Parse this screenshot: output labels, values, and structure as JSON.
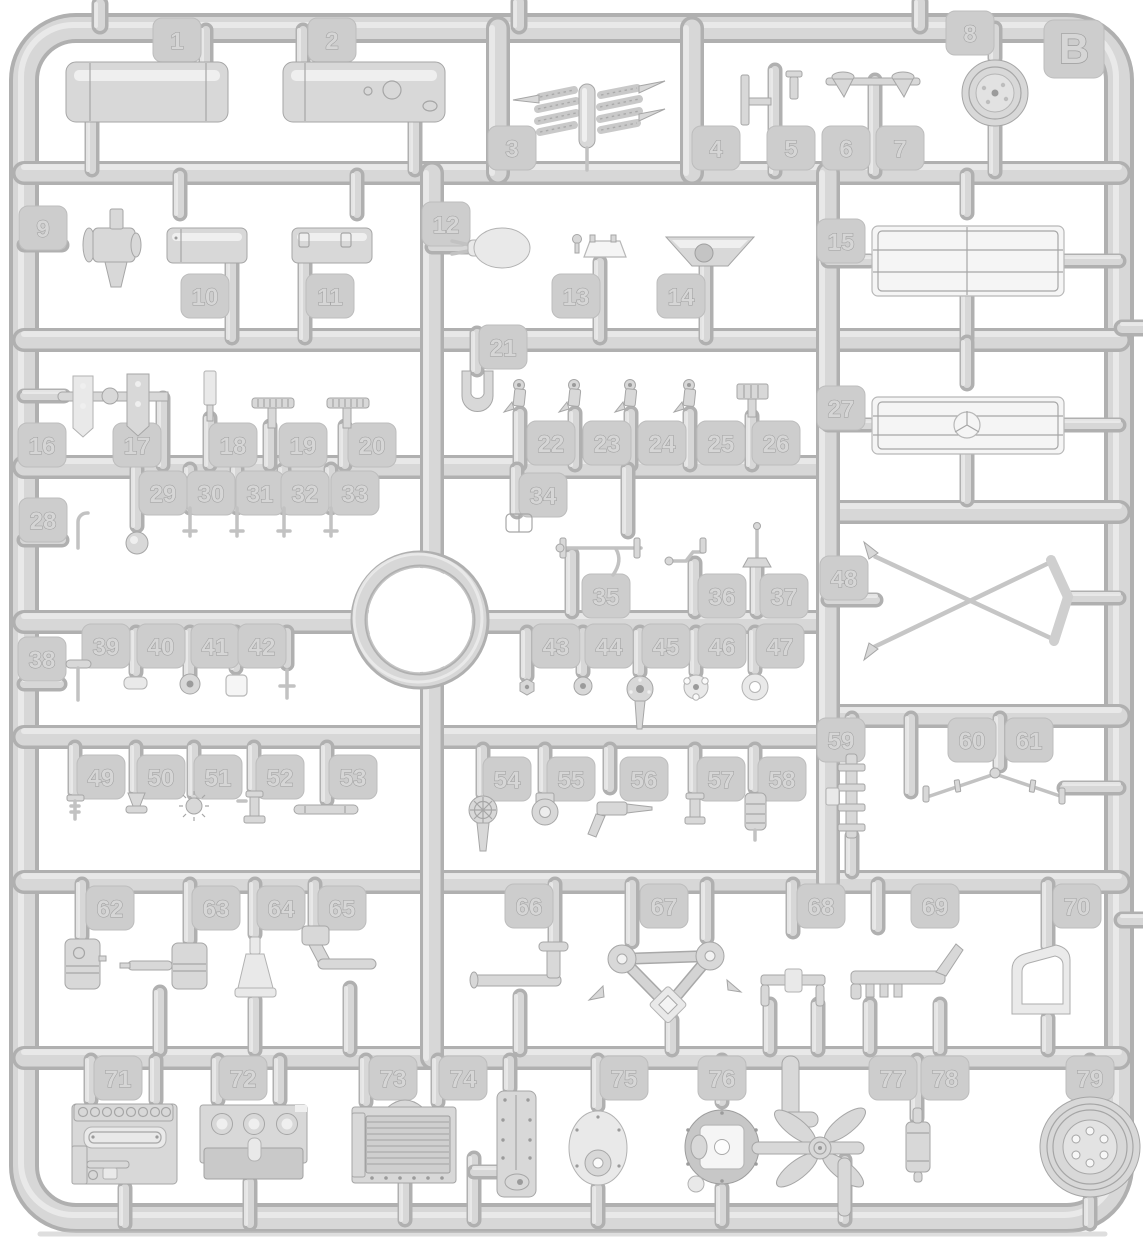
{
  "image": {
    "type": "model-kit-sprue-photo",
    "description": "Light gray injection-molded plastic sprue (parts tree) with numbered part tabs"
  },
  "sprue": {
    "letter": "B",
    "part_count": 79
  },
  "colors": {
    "background": "#ffffff",
    "plastic": "#d6d6d6",
    "plastic_shadow": "#b0b0b0",
    "plastic_highlight": "#eaeaea",
    "tab": "#cdcdcd",
    "emboss_outline": "#9d9d9d"
  },
  "parts": [
    {
      "number": 1,
      "name": "fuel-tank-cylinder"
    },
    {
      "number": 2,
      "name": "fuel-tank-cylinder-with-filler"
    },
    {
      "number": 3,
      "name": "leaf-spring-cluster"
    },
    {
      "number": 4,
      "name": "flat-mounting-plate"
    },
    {
      "number": 5,
      "name": "valve-bracket"
    },
    {
      "number": 6,
      "name": "air-horn-funnel"
    },
    {
      "number": 7,
      "name": "air-horn-funnel"
    },
    {
      "number": 8,
      "name": "pulley-wheel"
    },
    {
      "number": 9,
      "name": "water-pump"
    },
    {
      "number": 10,
      "name": "air-reservoir-tank"
    },
    {
      "number": 11,
      "name": "air-reservoir-tank"
    },
    {
      "number": 12,
      "name": "rounded-housing"
    },
    {
      "number": 13,
      "name": "seat-bracket"
    },
    {
      "number": 14,
      "name": "funnel-bowl"
    },
    {
      "number": 15,
      "name": "radiator-grille"
    },
    {
      "number": 16,
      "name": "mounting-plate"
    },
    {
      "number": 17,
      "name": "mounting-plate-with-ball"
    },
    {
      "number": 18,
      "name": "flat-strip"
    },
    {
      "number": 19,
      "name": "t-handle-ribbed"
    },
    {
      "number": 20,
      "name": "t-handle-ribbed"
    },
    {
      "number": 21,
      "name": "clevis-fork"
    },
    {
      "number": 22,
      "name": "shock-mount-bracket"
    },
    {
      "number": 23,
      "name": "shock-mount-bracket"
    },
    {
      "number": 24,
      "name": "shock-mount-bracket"
    },
    {
      "number": 25,
      "name": "shock-mount-bracket"
    },
    {
      "number": 26,
      "name": "ribbed-clamp-block"
    },
    {
      "number": 27,
      "name": "radiator-grille-with-emblem"
    },
    {
      "number": 28,
      "name": "hook-pin"
    },
    {
      "number": 29,
      "name": "cap-disc"
    },
    {
      "number": 30,
      "name": "small-pin"
    },
    {
      "number": 31,
      "name": "small-pin"
    },
    {
      "number": 32,
      "name": "small-pin"
    },
    {
      "number": 33,
      "name": "small-pin"
    },
    {
      "number": 34,
      "name": "buckle-frame"
    },
    {
      "number": 35,
      "name": "tie-rod-with-hook"
    },
    {
      "number": 36,
      "name": "lever-rod"
    },
    {
      "number": 37,
      "name": "gear-lever"
    },
    {
      "number": 38,
      "name": "flat-head-pin"
    },
    {
      "number": 39,
      "name": "rounded-pad"
    },
    {
      "number": 40,
      "name": "washer"
    },
    {
      "number": 41,
      "name": "square-pad"
    },
    {
      "number": 42,
      "name": "cross-pin"
    },
    {
      "number": 43,
      "name": "hex-nut"
    },
    {
      "number": 44,
      "name": "washer-disc"
    },
    {
      "number": 45,
      "name": "flanged-hub-with-blade"
    },
    {
      "number": 46,
      "name": "notched-disc"
    },
    {
      "number": 47,
      "name": "ring-grommet"
    },
    {
      "number": 48,
      "name": "scissor-cross-linkage"
    },
    {
      "number": 49,
      "name": "threaded-bolt"
    },
    {
      "number": 50,
      "name": "valve-cone"
    },
    {
      "number": 51,
      "name": "star-knob"
    },
    {
      "number": 52,
      "name": "spool-fitting"
    },
    {
      "number": 53,
      "name": "rod-with-handle"
    },
    {
      "number": 54,
      "name": "handwheel-with-stem"
    },
    {
      "number": 55,
      "name": "eyelet-ring"
    },
    {
      "number": 56,
      "name": "nozzle-fitting"
    },
    {
      "number": 57,
      "name": "capped-bushing"
    },
    {
      "number": 58,
      "name": "ribbed-canister"
    },
    {
      "number": 59,
      "name": "ladder-bracket"
    },
    {
      "number": 60,
      "name": "linkage-rod"
    },
    {
      "number": 61,
      "name": "linkage-rod"
    },
    {
      "number": 62,
      "name": "piston-cylinder"
    },
    {
      "number": 63,
      "name": "cylinder-with-side-rod"
    },
    {
      "number": 64,
      "name": "funnel-stand"
    },
    {
      "number": 65,
      "name": "crank-arm"
    },
    {
      "number": 66,
      "name": "exhaust-pipe-elbow"
    },
    {
      "number": 67,
      "name": "triangular-linkage-plate"
    },
    {
      "number": 68,
      "name": "t-bracket"
    },
    {
      "number": 69,
      "name": "manifold-bracket"
    },
    {
      "number": 70,
      "name": "d-shaped-cover-plate"
    },
    {
      "number": 71,
      "name": "engine-block"
    },
    {
      "number": 72,
      "name": "gearbox-mounting-plate"
    },
    {
      "number": 73,
      "name": "ribbed-oil-pan"
    },
    {
      "number": 74,
      "name": "side-cover-plate"
    },
    {
      "number": 75,
      "name": "oval-access-cover"
    },
    {
      "number": 76,
      "name": "round-hub-cover"
    },
    {
      "number": 77,
      "name": "cooling-fan-assembly"
    },
    {
      "number": 78,
      "name": "small-canister"
    },
    {
      "number": 79,
      "name": "road-wheel"
    }
  ]
}
